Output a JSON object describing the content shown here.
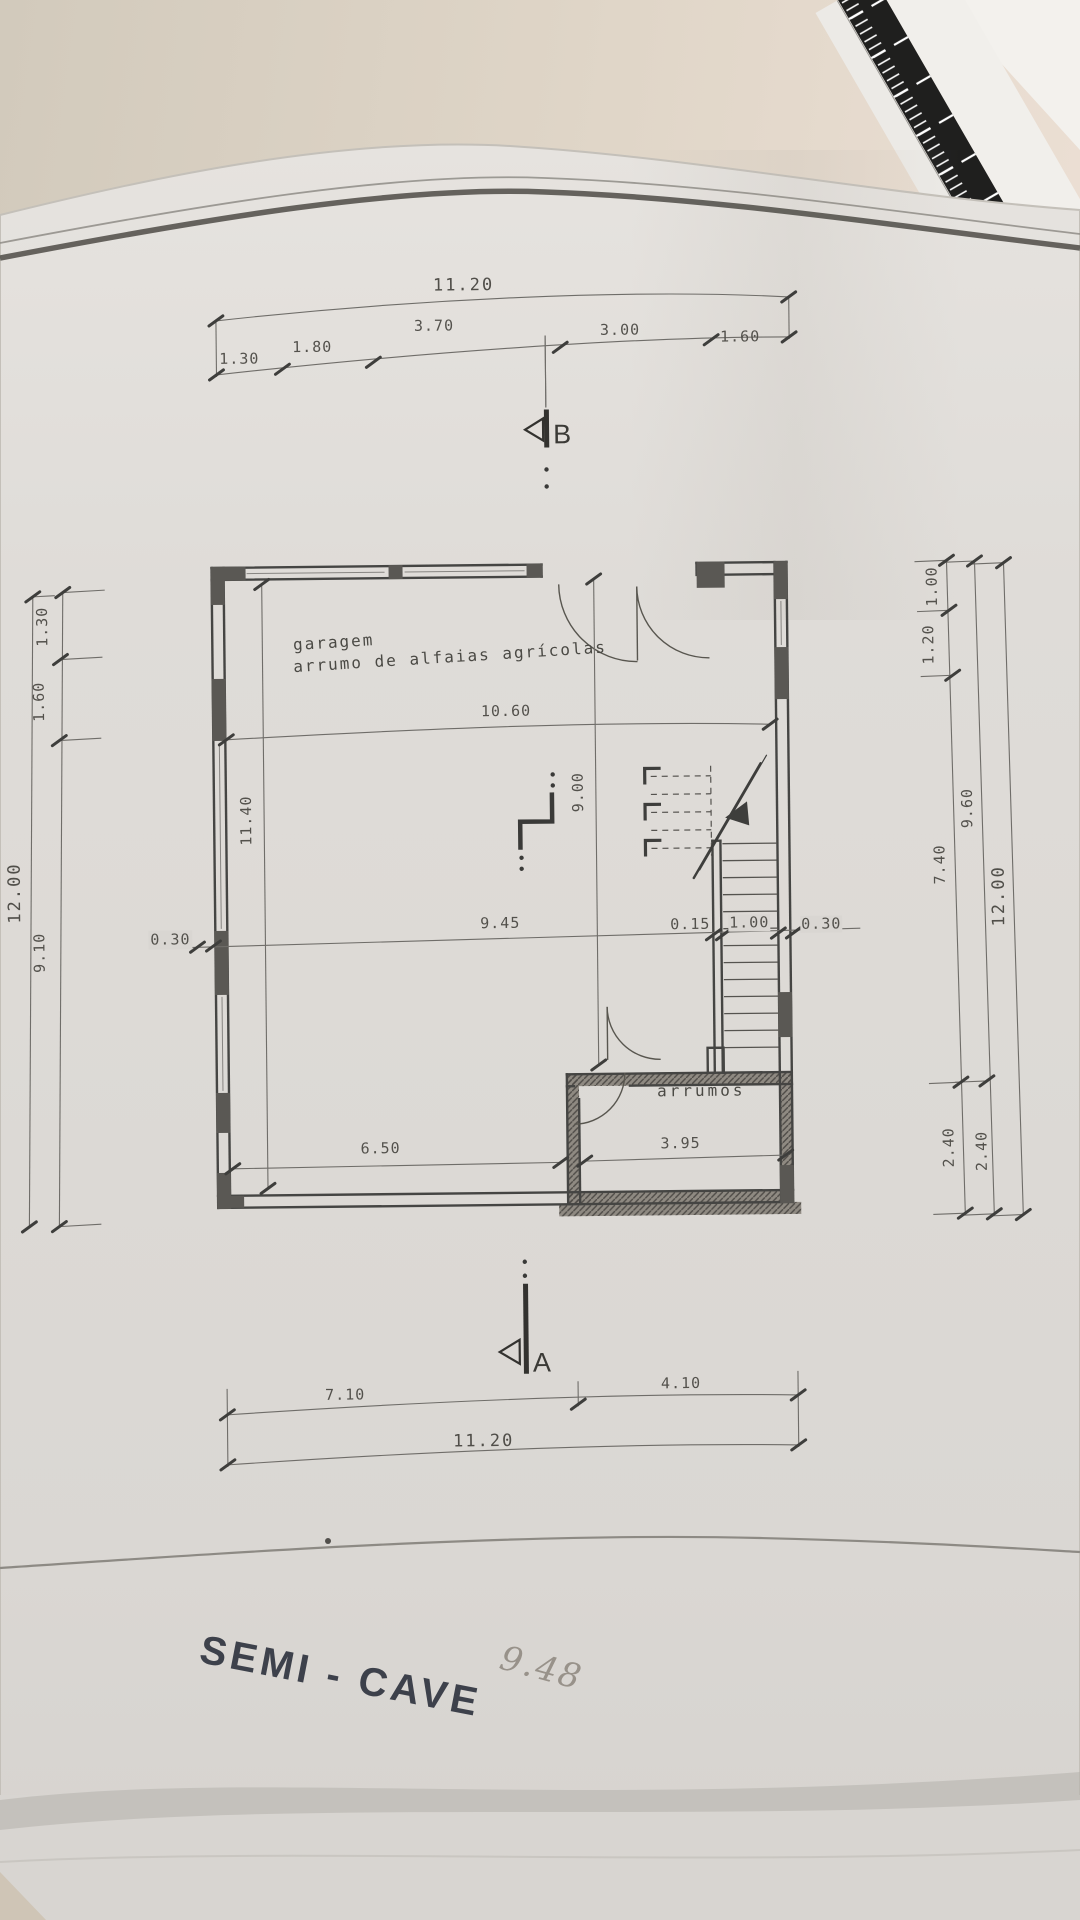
{
  "drawing": {
    "title": "SEMI - CAVE",
    "annotation": "9.48",
    "room_labels": {
      "garage_line1": "garagem",
      "garage_line2": "arrumo de alfaias agrícolas",
      "storage": "arrumos"
    },
    "section_markers": {
      "a": "A",
      "b": "B"
    },
    "dimensions": {
      "top": {
        "total": "11.20",
        "segments": [
          "1.30",
          "1.80",
          "3.70",
          "3.00",
          "1.60"
        ]
      },
      "bottom": {
        "total": "11.20",
        "segments": [
          "7.10",
          "4.10"
        ]
      },
      "left": {
        "total": "12.00",
        "segments": [
          "1.30",
          "1.60",
          "9.10"
        ]
      },
      "right": {
        "inner": [
          "1.00",
          "1.20",
          "7.40",
          "2.40"
        ],
        "middle": [
          "9.60",
          "2.40"
        ],
        "total": "12.00"
      },
      "interior": {
        "room_width": "10.60",
        "room_depth": "9.00",
        "room_depth_left": "11.40",
        "mid_span": "9.45",
        "wall_left": "0.30",
        "stair_partition": "0.15",
        "stair_width": "1.00",
        "wall_right": "0.30",
        "garage_bottom": "6.50",
        "storage_width": "3.95"
      }
    }
  },
  "colors": {
    "paper": "#e0ddd9",
    "desk": "#d6cdbf",
    "ink": "#45443f",
    "title_ink": "#3d414b",
    "pencil": "#98928a",
    "ruler_black": "#1f1f1e"
  }
}
